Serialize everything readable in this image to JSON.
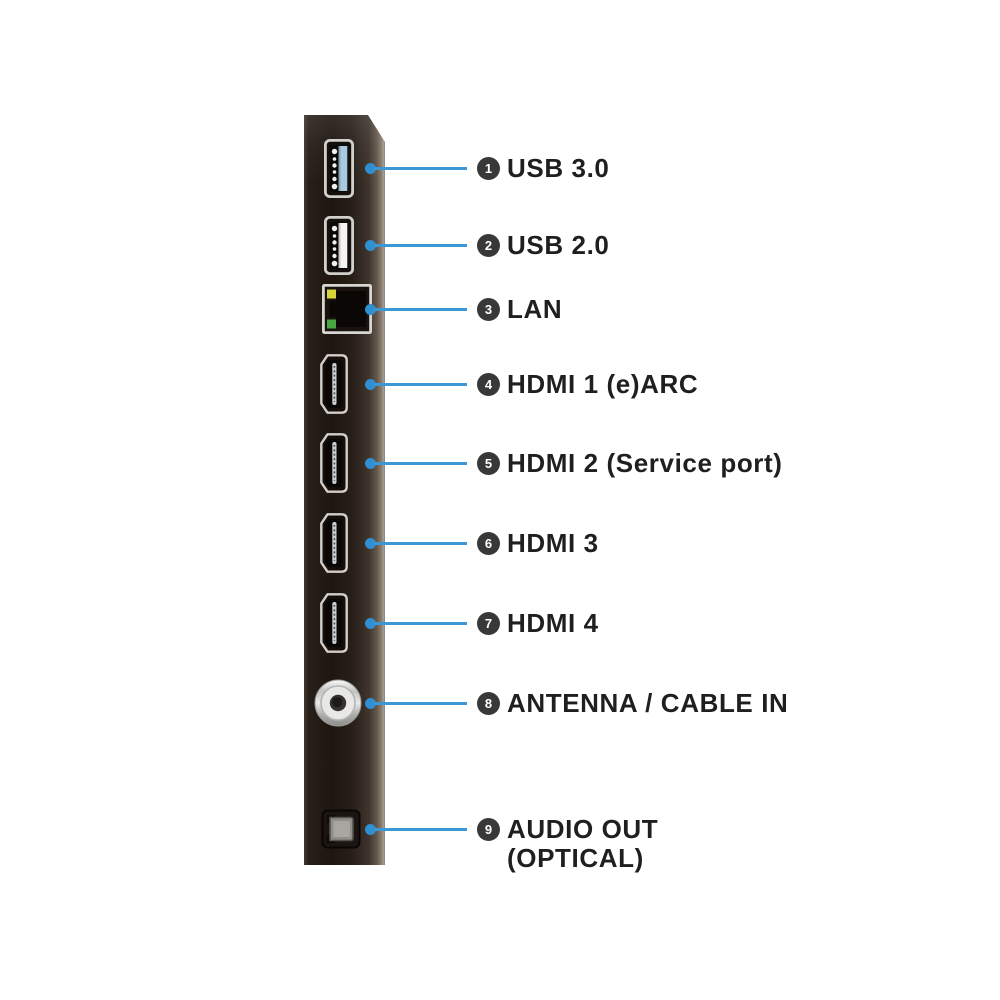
{
  "diagram_title": "",
  "colors": {
    "background": "#ffffff",
    "line_blue": "#3b98d5",
    "dot_blue": "#2f8fd0",
    "badge_background": "#383838",
    "badge_number": "#ffffff",
    "label_text": "#1f1f1f",
    "panel_dark": "#1f1610",
    "panel_edge_highlight": "#a89d90",
    "usb3_tab": "#a9c9e0",
    "usb2_tab": "#f4f4f2",
    "lan_led_yellow": "#d8d43c",
    "lan_led_green": "#47a63f"
  },
  "ports": [
    {
      "number": "1",
      "label": "USB 3.0",
      "type": "usb3",
      "icon": "usb3-port-icon"
    },
    {
      "number": "2",
      "label": "USB 2.0",
      "type": "usb2",
      "icon": "usb2-port-icon"
    },
    {
      "number": "3",
      "label": "LAN",
      "type": "lan",
      "icon": "lan-port-icon"
    },
    {
      "number": "4",
      "label": "HDMI 1 (e)ARC",
      "type": "hdmi",
      "icon": "hdmi-port-icon"
    },
    {
      "number": "5",
      "label": "HDMI 2 (Service port)",
      "type": "hdmi",
      "icon": "hdmi-port-icon"
    },
    {
      "number": "6",
      "label": "HDMI 3",
      "type": "hdmi",
      "icon": "hdmi-port-icon"
    },
    {
      "number": "7",
      "label": "HDMI 4",
      "type": "hdmi",
      "icon": "hdmi-port-icon"
    },
    {
      "number": "8",
      "label": "ANTENNA / CABLE IN",
      "type": "coax",
      "icon": "coax-antenna-port-icon"
    },
    {
      "number": "9",
      "label": "AUDIO OUT (OPTICAL)",
      "type": "optical",
      "icon": "optical-audio-port-icon"
    }
  ]
}
